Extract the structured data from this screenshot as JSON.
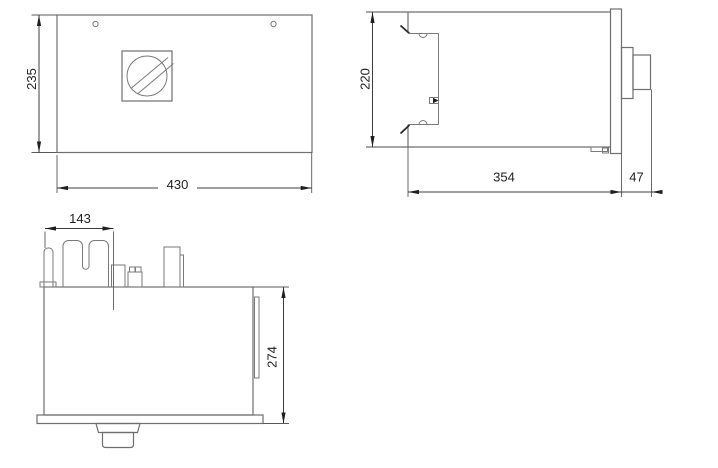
{
  "drawing": {
    "type": "technical-dimension-drawing",
    "views": {
      "front": {
        "name": "front view",
        "features": [
          "mounting-hole-left",
          "mounting-hole-right",
          "screw-knob"
        ]
      },
      "side": {
        "name": "side view",
        "features": [
          "din-clip-bracket",
          "front-bezel",
          "knob-collar",
          "knob"
        ]
      },
      "bottom": {
        "name": "terminal side view",
        "features": [
          "terminal-block",
          "base-plate",
          "bottom-plug",
          "side-rail"
        ]
      }
    },
    "dimensions": {
      "front_height": "235",
      "front_width": "430",
      "side_height": "220",
      "side_depth": "354",
      "side_front_depth": "47",
      "terminal_width": "143",
      "bottom_height": "274"
    },
    "colors": {
      "background": "#ffffff",
      "object_line": "#6f6f6f",
      "dimension_line": "#3c3c3c",
      "text": "#1f1f1f"
    }
  }
}
